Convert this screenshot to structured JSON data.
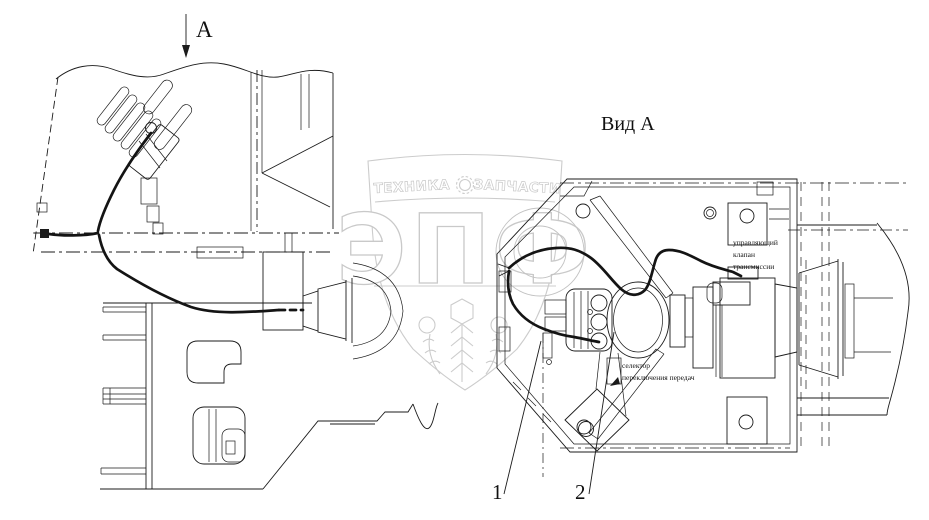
{
  "figure": {
    "background": "#ffffff",
    "ink_color": "#1b1b1b",
    "watermark_color": "#cccccc"
  },
  "labels": {
    "view_title": "Вид А",
    "section_arrow": "А",
    "callout_1": "1",
    "callout_2": "2"
  },
  "annotations": {
    "valve_line_1": "управляющий",
    "valve_line_2": "клапан",
    "valve_line_3": "трансмиссии",
    "selector_line_1": "селектор",
    "selector_line_2": "переключения передач"
  },
  "watermark": {
    "arc_left": "ТЕХНИКА",
    "arc_right": "ЗАПЧАСТИ",
    "brand": "ЭПФ"
  }
}
